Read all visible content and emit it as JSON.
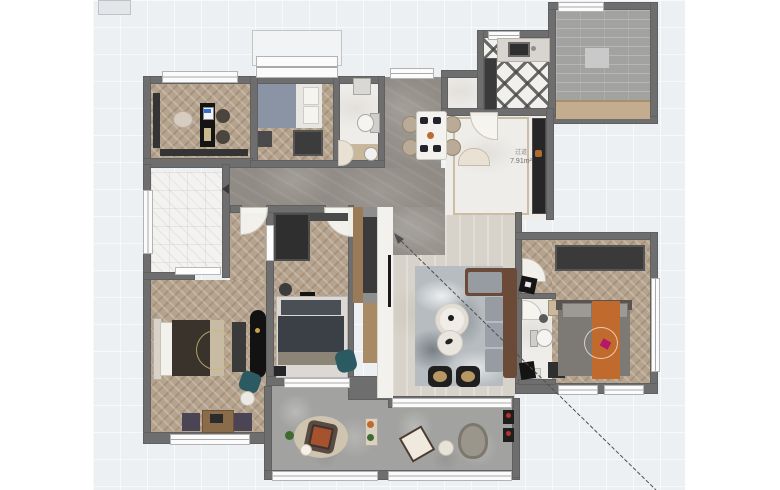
{
  "canvas": {
    "background": "#ffffff",
    "grid_bg": "#edf0f3",
    "grid_line": "#f7f9fa",
    "grid_size_px": 27
  },
  "palette": {
    "wall": "#6e6e6e",
    "wood_floor": "#b5a38e",
    "marble": "#908b84",
    "concrete": "#a2a2a0",
    "travertine": "#d8d3ca",
    "accent_teal": "#2c5a63",
    "accent_orange": "#c06a2e",
    "sofa_brown": "#6b4b38",
    "cabinet_dark": "#343434"
  },
  "labels": {
    "foyer_area": {
      "title": "过道",
      "value": "7.91m²"
    }
  },
  "annotation": {
    "x1": 397,
    "y1": 237,
    "x2": 656,
    "y2": 490
  }
}
